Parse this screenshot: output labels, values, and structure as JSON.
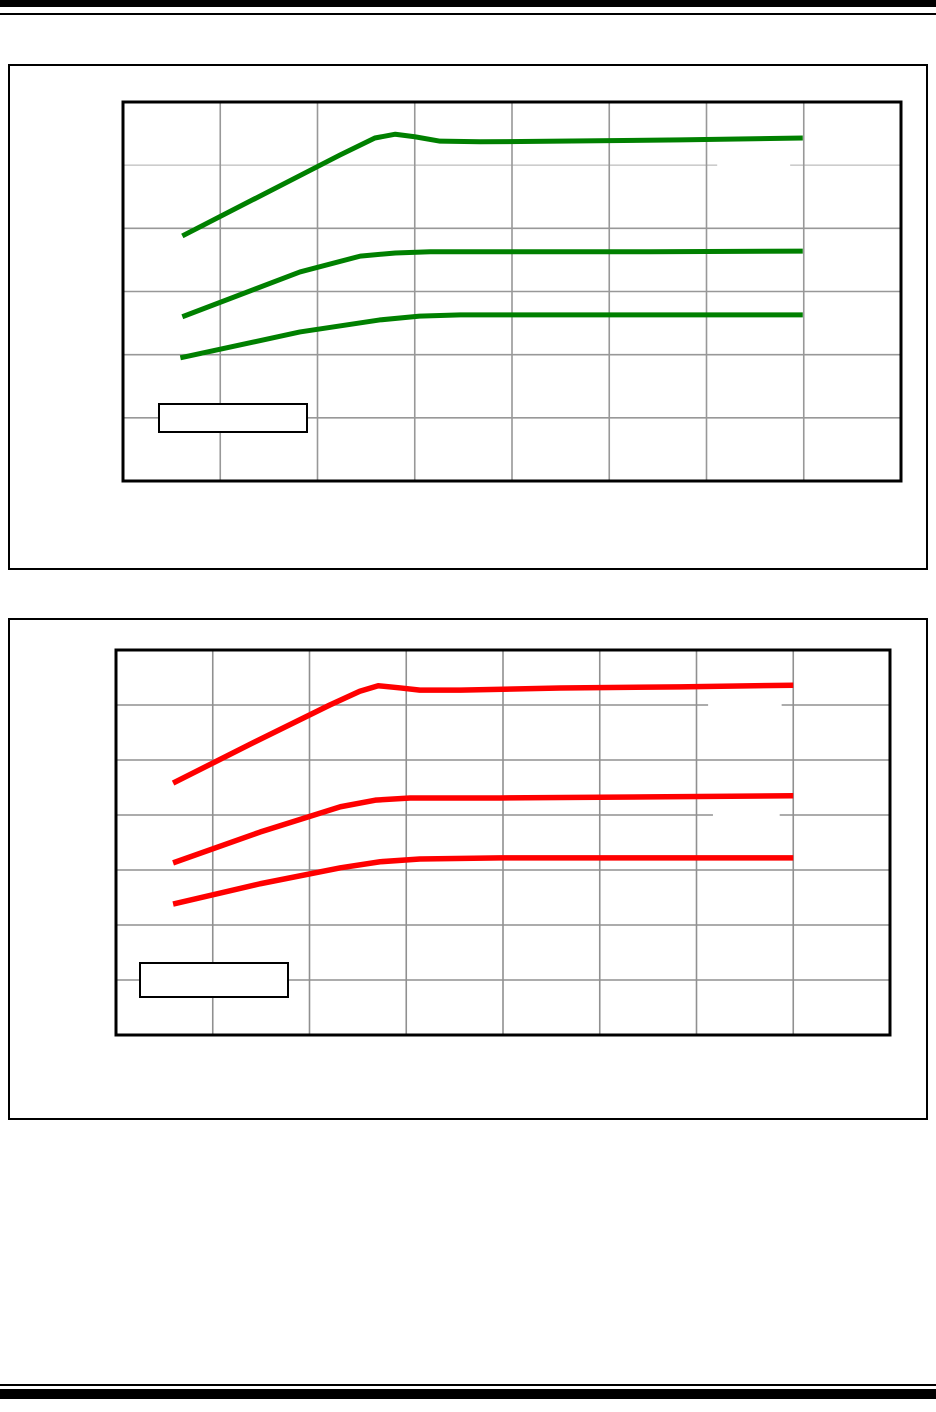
{
  "page": {
    "background": "#ffffff",
    "rule_color": "#000000"
  },
  "chart_data": [
    {
      "type": "line",
      "title": "",
      "xlabel": "",
      "ylabel": "",
      "tick_labels_visible": false,
      "line_color": "#008000",
      "line_width": 5,
      "plot": {
        "x": 123,
        "y": 102,
        "w": 778,
        "h": 379
      },
      "grid": {
        "cols": 8,
        "rows": 6,
        "color": "#989898",
        "light_rows": [
          5
        ],
        "light_color": "#cccccc"
      },
      "gridline_gaps": [
        {
          "row": 5,
          "from": 6.11,
          "to": 6.86
        }
      ],
      "legend": {
        "label": ""
      },
      "series": [
        {
          "name": "green-curve-top",
          "points_gridunits": [
            [
              0.61,
              3.88
            ],
            [
              2.23,
              5.16
            ],
            [
              2.59,
              5.43
            ],
            [
              2.8,
              5.49
            ],
            [
              3.0,
              5.45
            ],
            [
              3.26,
              5.38
            ],
            [
              3.67,
              5.37
            ],
            [
              4.49,
              5.38
            ],
            [
              5.73,
              5.4
            ],
            [
              6.99,
              5.43
            ]
          ]
        },
        {
          "name": "green-curve-middle",
          "points_gridunits": [
            [
              0.61,
              2.6
            ],
            [
              1.82,
              3.31
            ],
            [
              2.44,
              3.56
            ],
            [
              2.8,
              3.61
            ],
            [
              3.16,
              3.63
            ],
            [
              3.88,
              3.63
            ],
            [
              5.42,
              3.63
            ],
            [
              6.99,
              3.64
            ]
          ]
        },
        {
          "name": "green-curve-bottom",
          "points_gridunits": [
            [
              0.59,
              1.95
            ],
            [
              1.82,
              2.36
            ],
            [
              2.64,
              2.55
            ],
            [
              3.05,
              2.61
            ],
            [
              3.47,
              2.63
            ],
            [
              4.49,
              2.63
            ],
            [
              5.93,
              2.63
            ],
            [
              6.99,
              2.63
            ]
          ]
        }
      ]
    },
    {
      "type": "line",
      "title": "",
      "xlabel": "",
      "ylabel": "",
      "tick_labels_visible": false,
      "line_color": "#ff0000",
      "line_width": 5.5,
      "plot": {
        "x": 116,
        "y": 650,
        "w": 774,
        "h": 385
      },
      "grid": {
        "cols": 8,
        "rows": 7,
        "color": "#909090",
        "light_rows": [],
        "light_color": "#cccccc"
      },
      "gridline_gaps": [
        {
          "row": 6,
          "from": 6.12,
          "to": 6.88
        },
        {
          "row": 4,
          "from": 6.17,
          "to": 6.86
        }
      ],
      "legend": {
        "label": ""
      },
      "series": [
        {
          "name": "red-curve-top",
          "points_gridunits": [
            [
              0.59,
              4.58
            ],
            [
              1.39,
              5.29
            ],
            [
              2.21,
              6.0
            ],
            [
              2.52,
              6.25
            ],
            [
              2.71,
              6.35
            ],
            [
              2.94,
              6.31
            ],
            [
              3.14,
              6.27
            ],
            [
              3.56,
              6.27
            ],
            [
              4.59,
              6.31
            ],
            [
              5.83,
              6.33
            ],
            [
              7.0,
              6.36
            ]
          ]
        },
        {
          "name": "red-curve-middle",
          "points_gridunits": [
            [
              0.59,
              3.13
            ],
            [
              1.49,
              3.69
            ],
            [
              2.32,
              4.15
            ],
            [
              2.68,
              4.27
            ],
            [
              3.04,
              4.31
            ],
            [
              3.97,
              4.31
            ],
            [
              5.52,
              4.33
            ],
            [
              7.0,
              4.35
            ]
          ]
        },
        {
          "name": "red-curve-bottom",
          "points_gridunits": [
            [
              0.59,
              2.38
            ],
            [
              1.49,
              2.75
            ],
            [
              2.32,
              3.04
            ],
            [
              2.73,
              3.15
            ],
            [
              3.14,
              3.2
            ],
            [
              3.97,
              3.22
            ],
            [
              5.52,
              3.22
            ],
            [
              7.0,
              3.22
            ]
          ]
        }
      ]
    }
  ]
}
